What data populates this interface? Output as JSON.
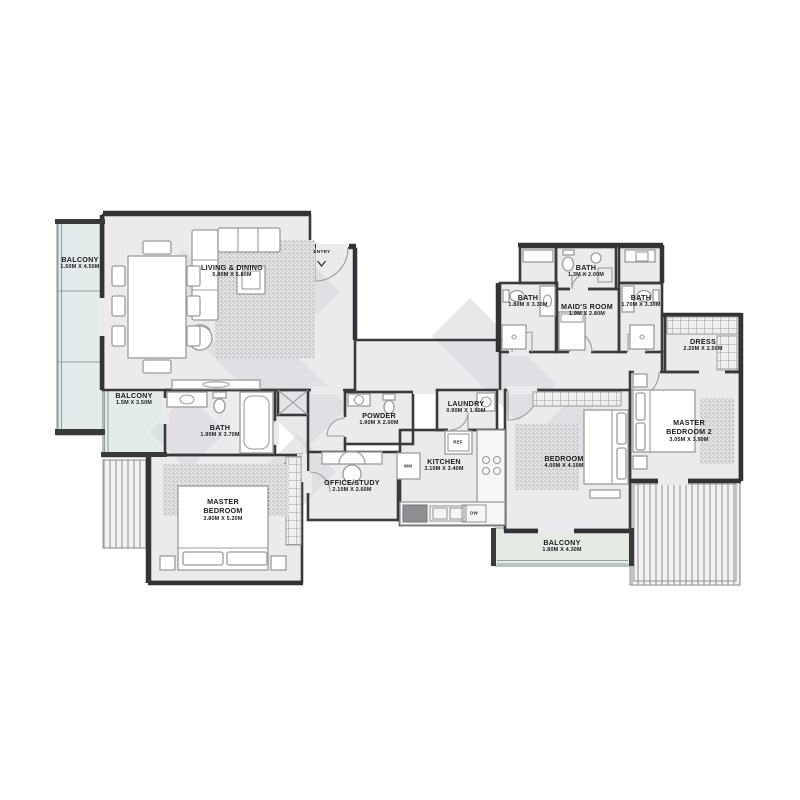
{
  "plan": {
    "type": "apartment-floor-plan",
    "entry": {
      "label": "ENTRY"
    },
    "rooms": [
      {
        "id": "balcony-top-left",
        "name": "BALCONY",
        "dims": "1.50M X 4.50M"
      },
      {
        "id": "living-dining",
        "name": "LIVING & DINING",
        "dims": "5.80M X 5.80M"
      },
      {
        "id": "balcony-left",
        "name": "BALCONY",
        "dims": "1.5M X 3.50M"
      },
      {
        "id": "master-bath",
        "name": "BATH",
        "dims": "1.90M X 3.70M"
      },
      {
        "id": "master-bedroom",
        "name": "MASTER BEDROOM",
        "dims": "3.80M X 5.20M"
      },
      {
        "id": "powder",
        "name": "POWDER",
        "dims": "1.90M X 2.00M"
      },
      {
        "id": "office-study",
        "name": "OFFICE/STUDY",
        "dims": "2.10M X 2.60M"
      },
      {
        "id": "kitchen",
        "name": "KITCHEN",
        "dims": "3.10M X 3.40M"
      },
      {
        "id": "laundry",
        "name": "LAUNDRY",
        "dims": "0.90M X 1.60M"
      },
      {
        "id": "maids-bath",
        "name": "BATH",
        "dims": "1.3M X 2.00M"
      },
      {
        "id": "bath-3",
        "name": "BATH",
        "dims": "1.80M X 3.30M"
      },
      {
        "id": "maids-room",
        "name": "MAID'S ROOM",
        "dims": "1.9M X 2.80M"
      },
      {
        "id": "bath-4",
        "name": "BATH",
        "dims": "1.70M X 3.30M"
      },
      {
        "id": "dress",
        "name": "DRESS",
        "dims": "2.20M X 2.50M"
      },
      {
        "id": "master-bedroom-2",
        "name": "MASTER BEDROOM 2",
        "dims": "3.05M X 3.90M"
      },
      {
        "id": "bedroom",
        "name": "BEDROOM",
        "dims": "4.00M X 4.10M"
      },
      {
        "id": "balcony-bottom",
        "name": "BALCONY",
        "dims": "1.80M X 4.30M"
      }
    ],
    "appliances": {
      "refrigerator": "REF",
      "dishwasher": "DW",
      "washing_machine": "WM"
    },
    "colors": {
      "wall": "#3a3a3c",
      "floor": "#ebebee",
      "balcony_tint": "#e4ebeb",
      "balcony_green_tint": "#e5ebe3",
      "furniture_line": "#9b9b9b",
      "watermark": "#d9d9dd",
      "background": "#ffffff"
    }
  }
}
